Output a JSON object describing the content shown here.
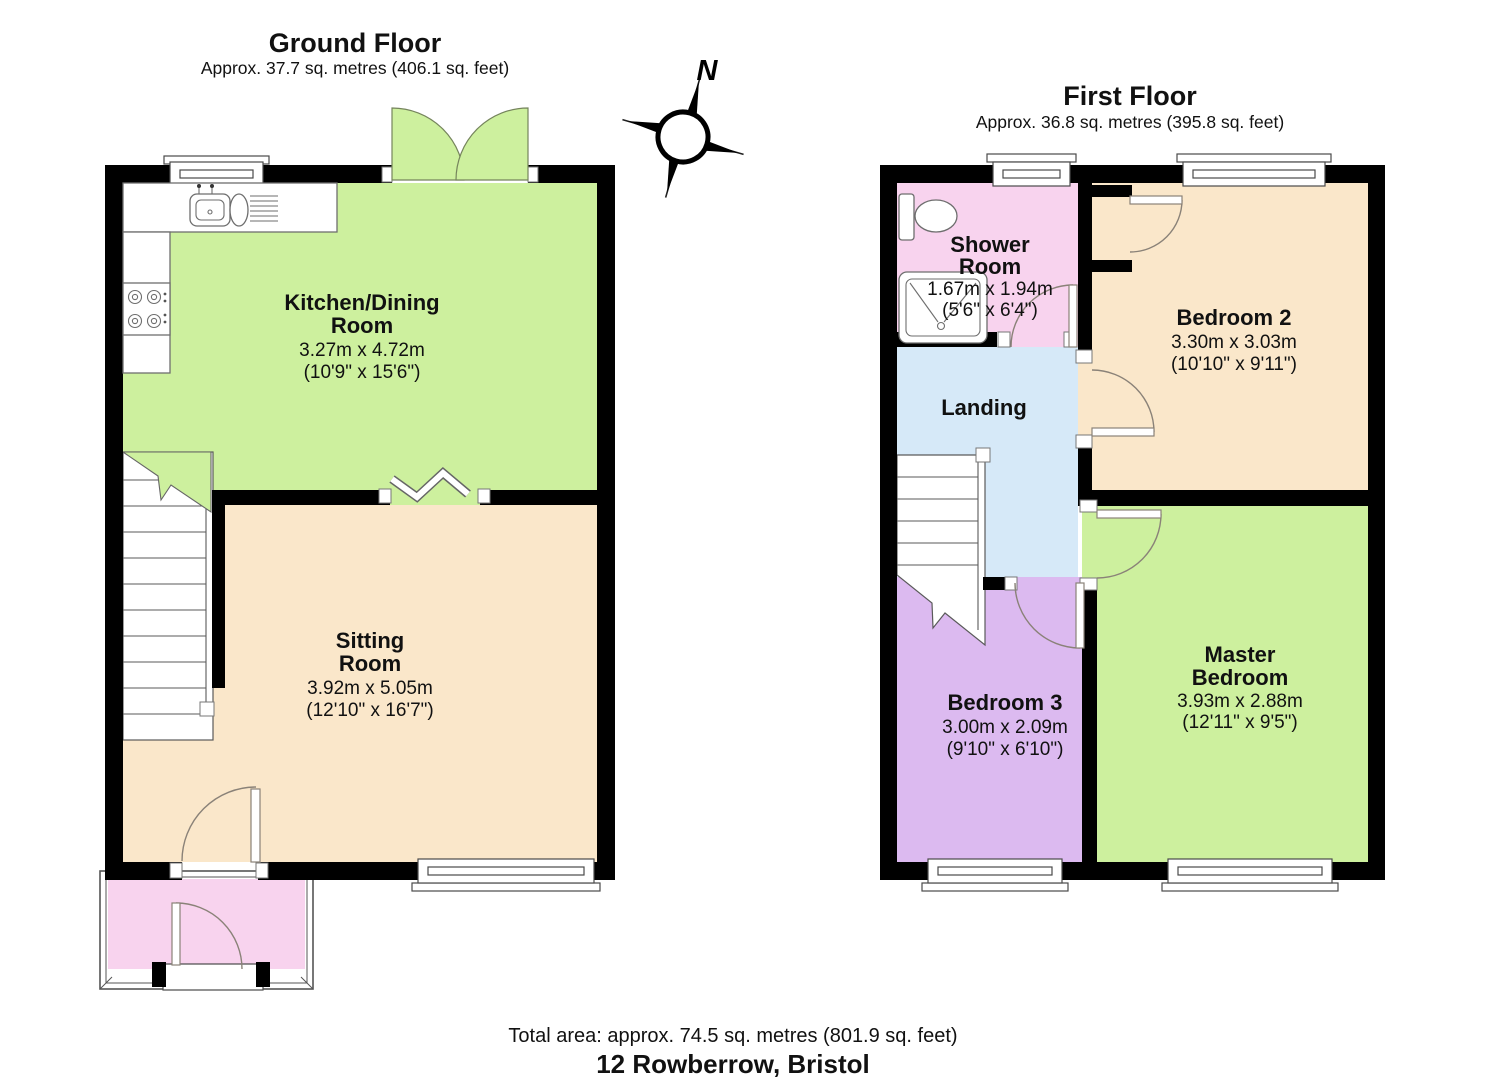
{
  "header": {
    "ground": {
      "title": "Ground Floor",
      "subtitle": "Approx. 37.7 sq. metres (406.1 sq. feet)"
    },
    "first": {
      "title": "First Floor",
      "subtitle": "Approx. 36.8 sq. metres (395.8 sq. feet)"
    }
  },
  "compass": {
    "north": "N"
  },
  "rooms": {
    "kitchen": {
      "line1": "Kitchen/Dining",
      "line2": "Room",
      "metric": "3.27m x 4.72m",
      "imperial": "(10'9\" x 15'6\")"
    },
    "sitting": {
      "line1": "Sitting",
      "line2": "Room",
      "metric": "3.92m x 5.05m",
      "imperial": "(12'10\" x 16'7\")"
    },
    "shower": {
      "line1": "Shower",
      "line2": "Room",
      "metric": "1.67m x 1.94m",
      "imperial": "(5'6\" x 6'4\")"
    },
    "landing": {
      "line1": "Landing"
    },
    "bedroom2": {
      "line1": "Bedroom 2",
      "metric": "3.30m x 3.03m",
      "imperial": "(10'10\" x 9'11\")"
    },
    "master": {
      "line1": "Master",
      "line2": "Bedroom",
      "metric": "3.93m x 2.88m",
      "imperial": "(12'11\" x 9'5\")"
    },
    "bedroom3": {
      "line1": "Bedroom 3",
      "metric": "3.00m x 2.09m",
      "imperial": "(9'10\" x 6'10\")"
    }
  },
  "footer": {
    "total": "Total area: approx. 74.5 sq. metres (801.9 sq. feet)",
    "address": "12 Rowberrow, Bristol"
  },
  "colors": {
    "green": "#cdf09e",
    "peach": "#fae7ca",
    "pink": "#f8d3ee",
    "blue": "#d6e9f8",
    "purple": "#dcbaf0",
    "wall": "#000000"
  }
}
